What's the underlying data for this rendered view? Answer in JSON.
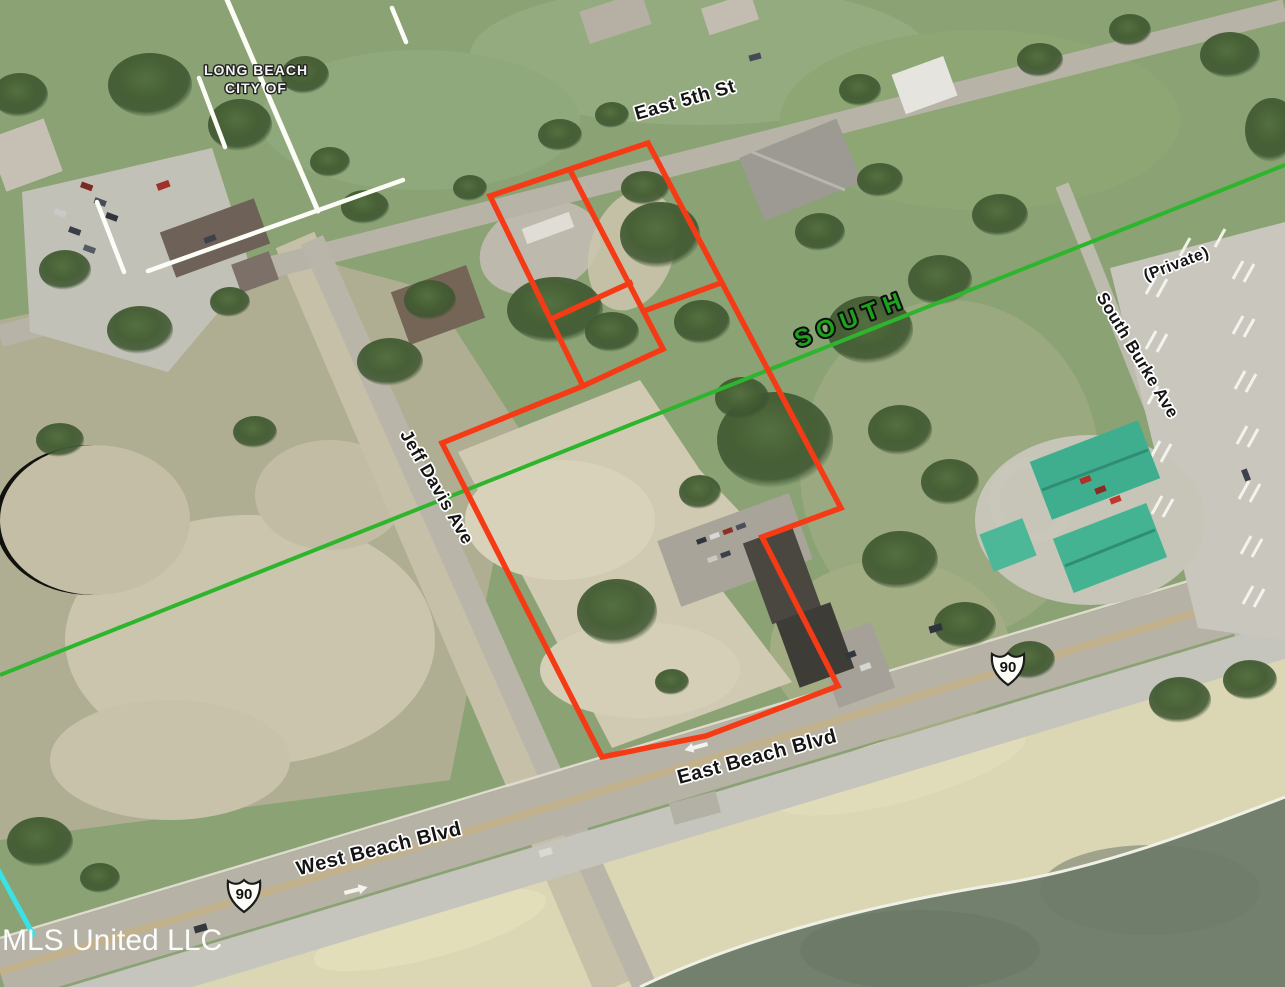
{
  "map": {
    "watermark": "MLS United LLC",
    "city_boundary_label": {
      "line1": "LONG BEACH",
      "line2": "CITY OF"
    },
    "section_label": "SOUTH",
    "streets": {
      "east_5th": "East 5th St",
      "jeff_davis": "Jeff Davis Ave",
      "south_burke": "South Burke Ave",
      "private_road": "(Private)",
      "east_beach": "East Beach Blvd",
      "west_beach": "West Beach Blvd"
    },
    "route_shields": {
      "west": "90",
      "east": "90"
    },
    "colors": {
      "parcel_outline": "#f53b16",
      "section_line_green": "#2eb52e",
      "section_label_green": "#1ca21c",
      "city_boundary_white": "#fdfdf8",
      "shoreline_marker_cyan": "#3ae2e6",
      "water": "#73806e",
      "sand": "#dbd6b4",
      "grass": "#8ba275",
      "road": "#b6b3a6",
      "teal_roof": "#3fae8f"
    }
  }
}
